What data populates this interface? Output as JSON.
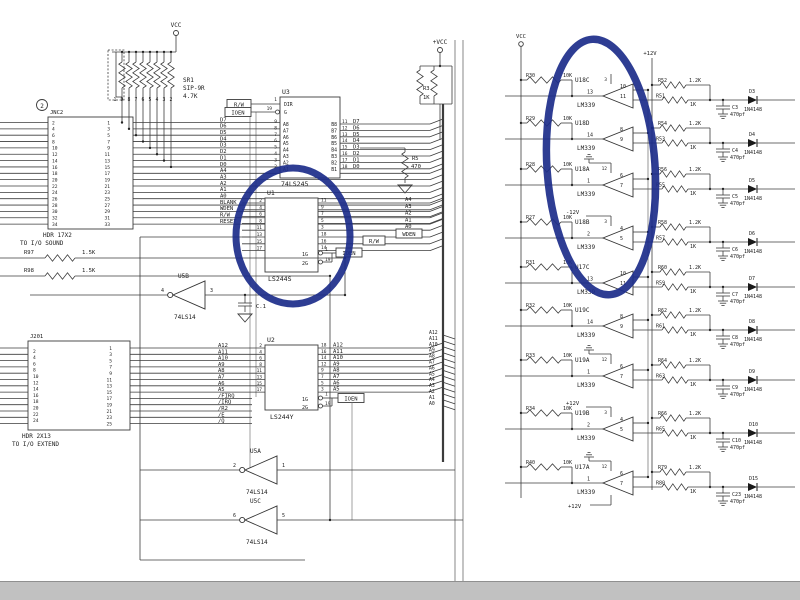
{
  "canvas": {
    "width": 800,
    "height": 600,
    "bg": "#ffffff",
    "line_color": "#3c3c3c"
  },
  "bottom_bar": {
    "color": "#c1c1c1"
  },
  "highlight": {
    "color": "#1c2d8a"
  },
  "left": {
    "vcc": "VCC",
    "page_ref": "2",
    "sr1": {
      "ref": "SR1",
      "series_label": "SIP-9R",
      "value": "4.7K",
      "pins": [
        "1",
        "9",
        "8",
        "7",
        "6",
        "5",
        "4",
        "3",
        "2"
      ]
    },
    "jnc2": {
      "title": "JNC2",
      "left_pins": [
        "2",
        "4",
        "6",
        "8",
        "10",
        "12",
        "14",
        "16",
        "18",
        "20",
        "22",
        "24",
        "26",
        "28",
        "30",
        "32",
        "34"
      ],
      "right_pins": [
        "1",
        "3",
        "5",
        "7",
        "9",
        "11",
        "13",
        "15",
        "17",
        "19",
        "21",
        "23",
        "25",
        "27",
        "29",
        "31",
        "33"
      ],
      "signals": [
        "D7",
        "D6",
        "D5",
        "D4",
        "D3",
        "D2",
        "D1",
        "D0",
        "A4",
        "A3",
        "A2",
        "A1",
        "A0",
        "BLANK",
        "WDEN",
        "R/W",
        "RESET"
      ],
      "note1": "HDR 17X2",
      "note2": "TO I/O SOUND"
    },
    "u3": {
      "ref": "U3",
      "part": "74LS245",
      "ctrl": [
        "DIR",
        "G"
      ],
      "ctrl_nums": [
        "1",
        "19"
      ],
      "ctrl_signals": [
        "R/W",
        "IOEN"
      ],
      "left_pins": [
        "A8",
        "A7",
        "A6",
        "A5",
        "A4",
        "A3",
        "A2",
        "A1"
      ],
      "left_nums": [
        "9",
        "8",
        "7",
        "6",
        "5",
        "4",
        "3",
        "2"
      ],
      "right_pins": [
        "B8",
        "B7",
        "B6",
        "B5",
        "B4",
        "B3",
        "B2",
        "B1"
      ],
      "right_nums": [
        "11",
        "12",
        "13",
        "14",
        "15",
        "16",
        "17",
        "18"
      ],
      "signals": [
        "D7",
        "D6",
        "D5",
        "D4",
        "D3",
        "D2",
        "D1",
        "D0"
      ]
    },
    "u1": {
      "ref": "U1",
      "part": "LS244S",
      "left_nums": [
        "2",
        "4",
        "6",
        "8",
        "11",
        "13",
        "15",
        "17"
      ],
      "right_nums": [
        "11",
        "9",
        "7",
        "5",
        "3",
        "18",
        "16",
        "14"
      ],
      "enables": [
        "1G",
        "2G"
      ],
      "enable_nums": [
        "1",
        "19"
      ],
      "enable_signal": "IOEN",
      "rw_signal": "R/W"
    },
    "u2": {
      "ref": "U2",
      "part": "LS244Y",
      "left_nums": [
        "2",
        "4",
        "6",
        "8",
        "11",
        "13",
        "15",
        "17"
      ],
      "right_nums": [
        "18",
        "16",
        "14",
        "12",
        "9",
        "7",
        "5",
        "3"
      ],
      "signals": [
        "A12",
        "A11",
        "A10",
        "A9",
        "A8",
        "A7",
        "A6",
        "A5"
      ],
      "enables": [
        "1G",
        "2G"
      ],
      "enable_nums": [
        "1",
        "19"
      ],
      "enable_signal": "IOEN"
    },
    "j201": {
      "title": "J201",
      "left_pins": [
        "2",
        "4",
        "6",
        "8",
        "10",
        "12",
        "14",
        "16",
        "18",
        "20",
        "22",
        "24"
      ],
      "right_pins": [
        "1",
        "3",
        "5",
        "7",
        "9",
        "11",
        "13",
        "15",
        "17",
        "19",
        "21",
        "23",
        "25"
      ],
      "signals": [
        "A12",
        "A11",
        "A10",
        "A9",
        "A8",
        "A7",
        "A6",
        "A5",
        "/FIRQ",
        "/IRQ",
        "/R2",
        "/E",
        "/Q"
      ],
      "note1": "HDR 2X13",
      "note2": "TO I/O EXTEND"
    },
    "u5a": {
      "ref": "U5A",
      "part": "74LS14",
      "out_pin": "2",
      "in_pin": "1"
    },
    "u5b": {
      "ref": "U5B",
      "part": "74LS14",
      "out_pin": "4",
      "in_pin": "3"
    },
    "u5c": {
      "ref": "U5C",
      "part": "74LS14",
      "out_pin": "6",
      "in_pin": "5"
    },
    "c1": "C.1",
    "r97": {
      "ref": "R97",
      "value": "1.5K"
    },
    "r98": {
      "ref": "R98",
      "value": "1.5K"
    },
    "r3": {
      "ref": "R3",
      "value": "1K",
      "vcc": "+VCC"
    },
    "r5": {
      "ref": "R5",
      "value": "470"
    },
    "bus_top": [
      "A4",
      "A3",
      "A2",
      "A1",
      "A0"
    ],
    "wden": "WDEN",
    "rw": "R/W",
    "bus_mid": [
      "A12",
      "A11",
      "A10",
      "A9",
      "A8",
      "A7",
      "A6",
      "A5",
      "A4",
      "A3",
      "A2",
      "A1",
      "A0"
    ]
  },
  "right": {
    "vcc": "VCC",
    "rail": "+12V",
    "stages": [
      {
        "res": "R30",
        "res_val": "10K",
        "comp": "U18C",
        "part": "LM339",
        "out": "13",
        "ins": [
          "10",
          "11"
        ],
        "pwr": "3",
        "pullup": "R52",
        "pullup_val": "1.2K",
        "series": "R51",
        "series_val": "1K",
        "cap": "C3",
        "cap_val": "470pf",
        "diode": "D3",
        "diode_part": "1N4148"
      },
      {
        "res": "R29",
        "res_val": "10K",
        "comp": "U18D",
        "part": "LM339",
        "out": "14",
        "ins": [
          "8",
          "9"
        ],
        "pullup": "R54",
        "pullup_val": "1.2K",
        "series": "R53",
        "series_val": "1K",
        "cap": "C4",
        "cap_val": "470pf",
        "diode": "D4",
        "diode_part": "1N4148"
      },
      {
        "res": "R28",
        "res_val": "10K",
        "comp": "U18A",
        "part": "LM339",
        "out": "1",
        "ins": [
          "6",
          "7"
        ],
        "gnd": true,
        "pwr": "12",
        "pullup": "R56",
        "pullup_val": "1.2K",
        "series": "R55",
        "series_val": "1K",
        "cap": "C5",
        "cap_val": "470pf",
        "diode": "D5",
        "diode_part": "1N4148"
      },
      {
        "res": "R27",
        "res_val": "10K",
        "comp": "U18B",
        "part": "LM339",
        "out": "2",
        "ins": [
          "4",
          "5"
        ],
        "bias": "-12V",
        "pwr": "3",
        "pullup": "R58",
        "pullup_val": "1.2K",
        "series": "R57",
        "series_val": "1K",
        "cap": "C6",
        "cap_val": "470pf",
        "diode": "D6",
        "diode_part": "1N4148"
      },
      {
        "res": "R31",
        "res_val": "10K",
        "comp": "U17C",
        "part": "LM339",
        "out": "13",
        "ins": [
          "10",
          "11"
        ],
        "pullup": "R60",
        "pullup_val": "1.2K",
        "series": "R59",
        "series_val": "1K",
        "cap": "C7",
        "cap_val": "470pf",
        "diode": "D7",
        "diode_part": "1N4148"
      },
      {
        "res": "R32",
        "res_val": "10K",
        "comp": "U19C",
        "part": "LM339",
        "out": "14",
        "ins": [
          "8",
          "9"
        ],
        "pullup": "R62",
        "pullup_val": "1.2K",
        "series": "R61",
        "series_val": "1K",
        "cap": "C8",
        "cap_val": "470pf",
        "diode": "D8",
        "diode_part": "1N4148"
      },
      {
        "res": "R33",
        "res_val": "10K",
        "comp": "U19A",
        "part": "LM339",
        "out": "1",
        "ins": [
          "6",
          "7"
        ],
        "gnd": true,
        "pwr": "12",
        "pullup": "R64",
        "pullup_val": "1.2K",
        "series": "R63",
        "series_val": "1K",
        "cap": "C9",
        "c_extra": "",
        "cap_val": "470pf",
        "diode": "D9",
        "diode_part": "1N4148"
      },
      {
        "res": "R34",
        "res_val": "10K",
        "comp": "U19B",
        "part": "LM339",
        "out": "2",
        "ins": [
          "4",
          "5"
        ],
        "bias": "+12V",
        "pwr": "3",
        "pullup": "R66",
        "pullup_val": "1.2K",
        "series": "R65",
        "series_val": "1K",
        "cap": "C10",
        "cap_val": "470pf",
        "diode": "D10",
        "diode_part": "1N4148"
      },
      {
        "res": "R40",
        "res_val": "10K",
        "comp": "U17A",
        "part": "LM339",
        "out": "1",
        "ins": [
          "6",
          "7"
        ],
        "gnd": true,
        "pwr": "12",
        "bias_below": "+12V",
        "pullup": "R79",
        "pullup_val": "1.2K",
        "series": "R80",
        "series_val": "1K",
        "cap": "C23",
        "cap_val": "470pf",
        "diode": "D15",
        "diode_part": "1N4148"
      }
    ]
  }
}
